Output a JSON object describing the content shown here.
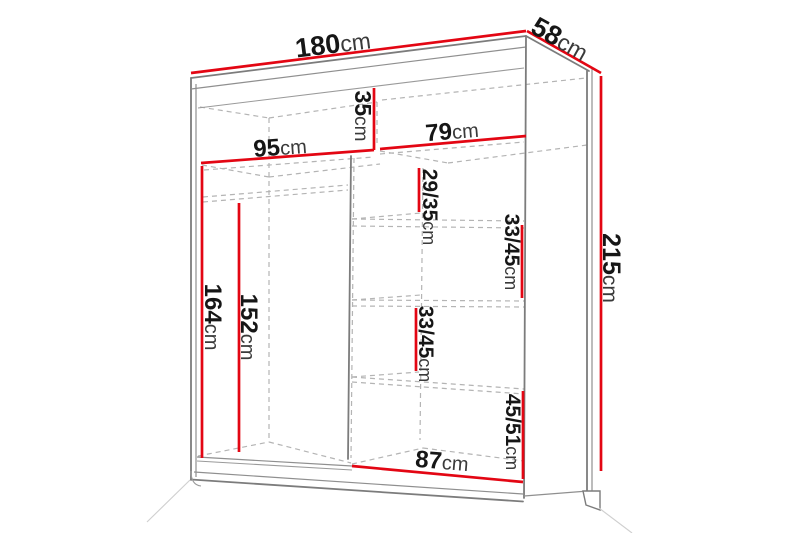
{
  "diagram": {
    "type": "furniture-dimension-drawing",
    "subject": "sliding-door wardrobe with shelves and hanging rail",
    "unit": "cm",
    "colors": {
      "dimension_line": "#e30613",
      "outline": "#7c7c7c",
      "hidden_line": "#b4b4b4",
      "text": "#1c1c1c",
      "background": "#ffffff"
    },
    "overall": {
      "width": {
        "value": "180",
        "unit": "cm"
      },
      "depth": {
        "value": "58",
        "unit": "cm"
      },
      "height": {
        "value": "215",
        "unit": "cm"
      }
    },
    "interior": {
      "left_section_width": {
        "value": "95",
        "unit": "cm"
      },
      "top_compartment_height": {
        "value": "35",
        "unit": "cm"
      },
      "right_section_width": {
        "value": "79",
        "unit": "cm"
      },
      "left_section_clear_height": {
        "value": "164",
        "unit": "cm"
      },
      "hanging_rail_height": {
        "value": "152",
        "unit": "cm"
      },
      "right_shelf_gap_1": {
        "value": "29/35",
        "unit": "cm"
      },
      "right_shelf_gap_2": {
        "value": "33/45",
        "unit": "cm"
      },
      "right_shelf_gap_3": {
        "value": "33/45",
        "unit": "cm"
      },
      "right_bottom_compartment": {
        "value": "45/51",
        "unit": "cm"
      },
      "right_section_bottom_width": {
        "value": "87",
        "unit": "cm"
      }
    }
  }
}
